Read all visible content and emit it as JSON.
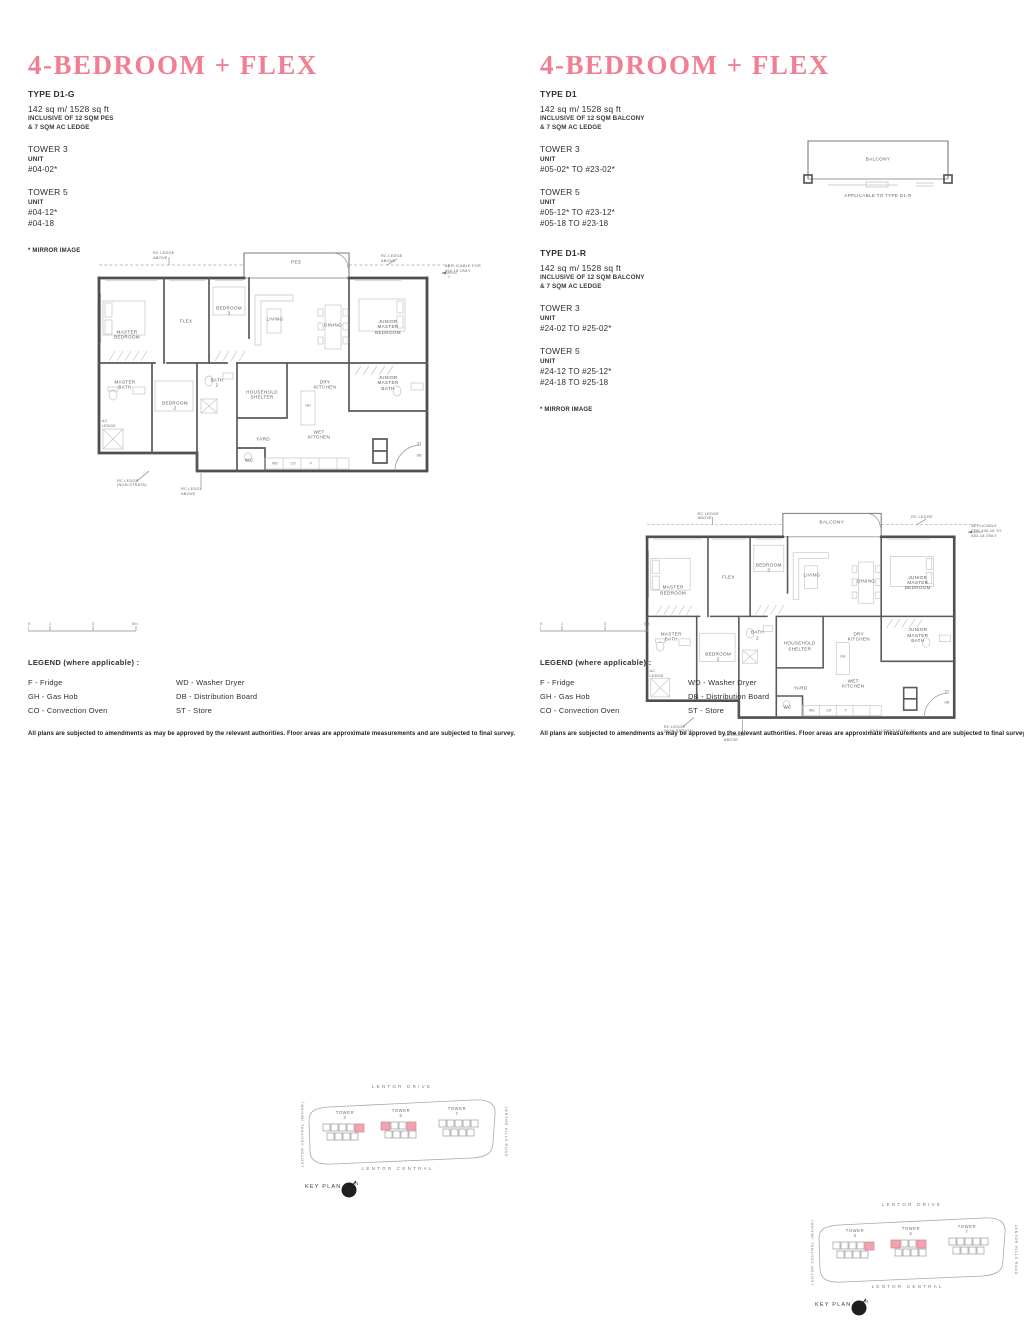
{
  "accent_color": "#f27e93",
  "highlight_color": "#f2a3b0",
  "disclaimer": "All plans are subjected to amendments as may be approved by the relevant authorities. Floor areas are approximate measurements and are subjected to final survey.",
  "legend": {
    "title": "LEGEND (where applicable) :",
    "col1": [
      "F - Fridge",
      "GH - Gas Hob",
      "CO - Convection Oven"
    ],
    "col2": [
      "WD - Washer Dryer",
      "DB - Distribution Board",
      "ST - Store"
    ]
  },
  "scalebar": {
    "ticks": [
      "0",
      "1",
      "3",
      "5m"
    ]
  },
  "keyplan": {
    "label": "KEY PLAN",
    "north_icon": "north-arrow",
    "roads": {
      "top": "LENTOR DRIVE",
      "bottom": "LENTOR CENTRAL",
      "left": "LENTOR CENTRAL (MINOR)",
      "right": "LENTOR HILLS ROAD"
    },
    "towers": [
      "TOWER\n3",
      "TOWER\n5",
      "TOWER\n7"
    ]
  },
  "plan_rooms": [
    {
      "label": "MASTER\nBEDROOM",
      "x": 30,
      "y": 92
    },
    {
      "label": "FLEX",
      "x": 89,
      "y": 78
    },
    {
      "label": "BEDROOM\n3",
      "x": 132,
      "y": 68
    },
    {
      "label": "LIVING",
      "x": 178,
      "y": 76
    },
    {
      "label": "DINING",
      "x": 236,
      "y": 82
    },
    {
      "label": "JUNIOR\nMASTER\nBEDROOM",
      "x": 291,
      "y": 84
    },
    {
      "label": "MASTER\nBATH",
      "x": 28,
      "y": 142
    },
    {
      "label": "BEDROOM\n2",
      "x": 78,
      "y": 163
    },
    {
      "label": "BATH\n2",
      "x": 120,
      "y": 140
    },
    {
      "label": "HOUSEHOLD\nSHELTER",
      "x": 165,
      "y": 152
    },
    {
      "label": "DRY\nKITCHEN",
      "x": 228,
      "y": 142
    },
    {
      "label": "WET\nKITCHEN",
      "x": 222,
      "y": 192
    },
    {
      "label": "YARD",
      "x": 166,
      "y": 196
    },
    {
      "label": "WC",
      "x": 152,
      "y": 217
    },
    {
      "label": "JUNIOR\nMASTER\nBATH",
      "x": 291,
      "y": 140
    },
    {
      "label": "WD",
      "x": 178,
      "y": 221,
      "small": true
    },
    {
      "label": "CO",
      "x": 196,
      "y": 221,
      "small": true
    },
    {
      "label": "F",
      "x": 214,
      "y": 221,
      "small": true
    },
    {
      "label": "GH",
      "x": 211,
      "y": 163,
      "small": true
    },
    {
      "label": "ST",
      "x": 322,
      "y": 201,
      "small": true
    },
    {
      "label": "DB",
      "x": 322,
      "y": 213,
      "small": true
    }
  ],
  "panels": [
    {
      "title": "4-BEDROOM + FLEX",
      "mirror_note": "* MIRROR IMAGE",
      "types": [
        {
          "name": "TYPE D1-G",
          "area": "142 sq m/ 1528 sq ft",
          "inclusive1": "INCLUSIVE OF 12 SQM PES",
          "inclusive2": "& 7 SQM AC LEDGE",
          "towers": [
            {
              "name": "TOWER 3",
              "unit_heading": "UNIT",
              "units": [
                "#04-02*"
              ]
            },
            {
              "name": "TOWER 5",
              "unit_heading": "UNIT",
              "units": [
                "#04-12*",
                "#04-18"
              ]
            }
          ]
        }
      ],
      "plan": {
        "outdoor": "PES",
        "note_top_left": "RC LEDGE\nABOVE",
        "note_top_right": "RC LEDGE\nABOVE",
        "note_side": "APPLICABLE FOR\n#04-18 ONLY",
        "note_bottom1": "RC LEDGE\n(NON-STRATA)",
        "note_bottom2": "RC LEDGE\nABOVE",
        "note_ac_ledge": "AC\nLEDGE",
        "note_excluding": ""
      }
    },
    {
      "title": "4-BEDROOM + FLEX",
      "mirror_note": "* MIRROR IMAGE",
      "types": [
        {
          "name": "TYPE D1",
          "area": "142 sq m/ 1528 sq ft",
          "inclusive1": "INCLUSIVE OF 12 SQM BALCONY",
          "inclusive2": "& 7 SQM AC LEDGE",
          "towers": [
            {
              "name": "TOWER 3",
              "unit_heading": "UNIT",
              "units": [
                "#05-02* TO #23-02*"
              ]
            },
            {
              "name": "TOWER 5",
              "unit_heading": "UNIT",
              "units": [
                "#05-12* TO #23-12*",
                "#05-18 TO #23-18"
              ]
            }
          ]
        },
        {
          "name": "TYPE D1-R",
          "area": "142 sq m/ 1528 sq ft",
          "inclusive1": "INCLUSIVE OF 12 SQM BALCONY",
          "inclusive2": "& 7 SQM AC LEDGE",
          "towers": [
            {
              "name": "TOWER 3",
              "unit_heading": "UNIT",
              "units": [
                "#24-02 TO #25-02*"
              ]
            },
            {
              "name": "TOWER 5",
              "unit_heading": "UNIT",
              "units": [
                "#24-12 TO #25-12*",
                "#24-18 TO #25-18"
              ]
            }
          ]
        }
      ],
      "plan": {
        "outdoor": "BALCONY",
        "note_top_left": "RC LEDGE\nABOVE",
        "note_top_right": "RC LEDGE",
        "note_side": "APPLICABLE\nFOR #05-18 TO\n#23-18 ONLY",
        "note_bottom1": "RC LEDGE\n(NON-STRATA)",
        "note_bottom2": "RC LEDGE\nABOVE",
        "note_ac_ledge": "AC\nLEDGE",
        "note_excluding": "EXCLUDING LEVEL 14"
      },
      "detail": {
        "label": "BALCONY",
        "caption": "APPLICABLE TO TYPE D1-R"
      }
    }
  ]
}
